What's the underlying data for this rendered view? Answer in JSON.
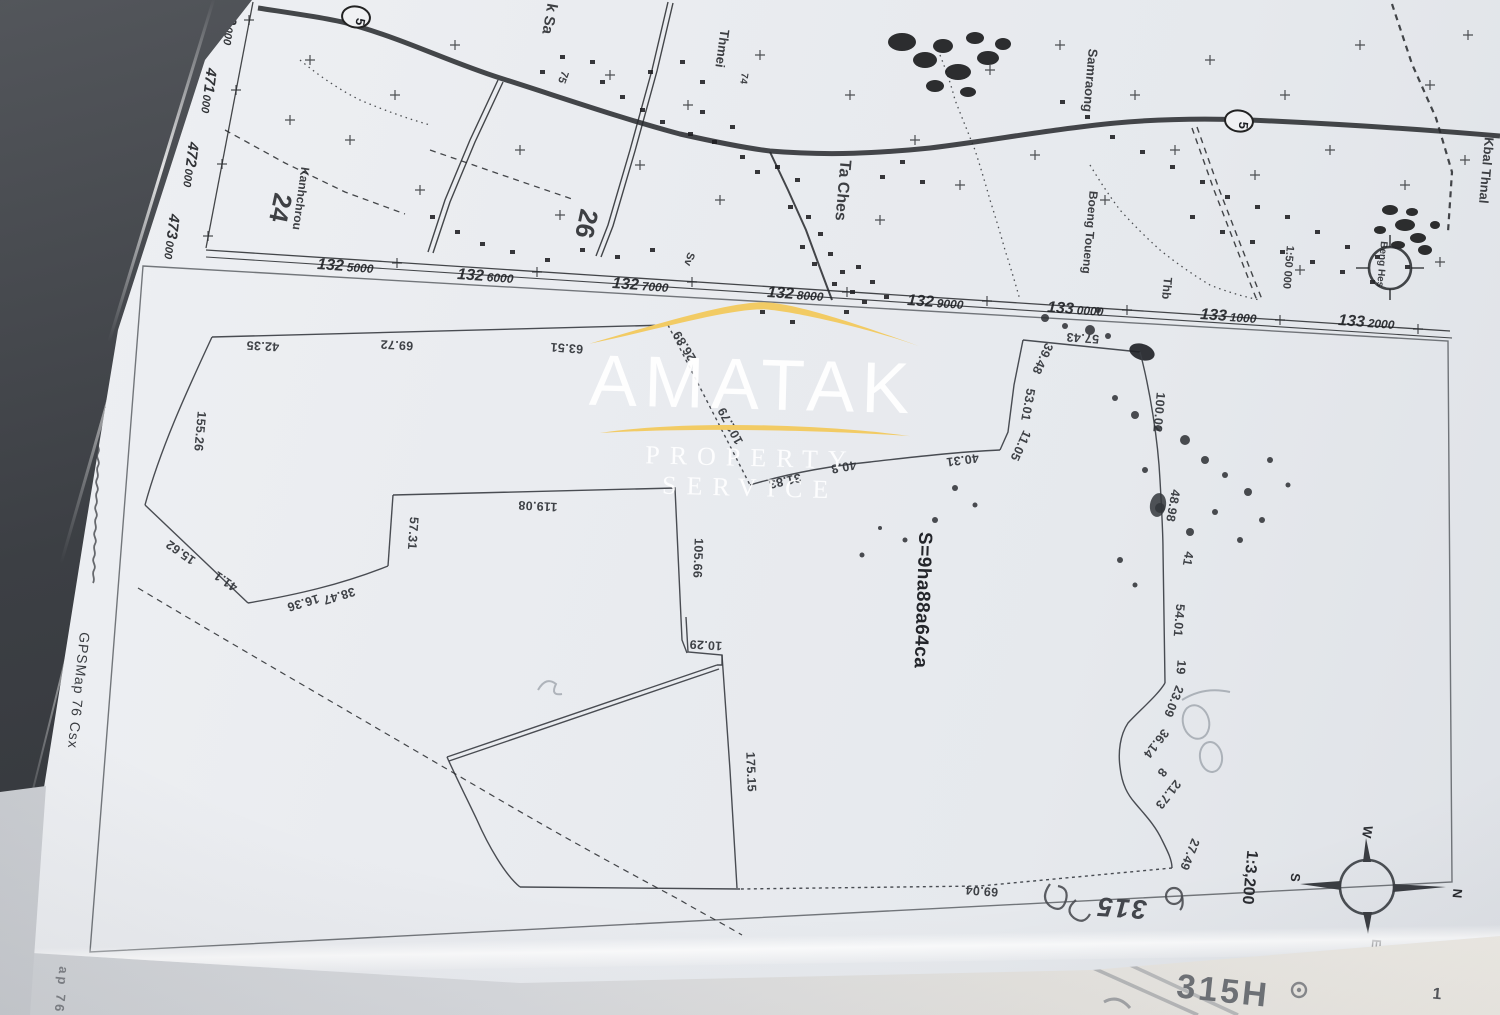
{
  "watermark": {
    "brand": "AMATAK",
    "tagline": "PROPERTY SERVICE",
    "accent_color": "#f2cb64",
    "text_color": "#ffffff"
  },
  "topo_map": {
    "grid_x_labels": [
      {
        "main": "132",
        "sub": "5000",
        "x": 345,
        "y": 271
      },
      {
        "main": "132",
        "sub": "6000",
        "x": 485,
        "y": 281
      },
      {
        "main": "132",
        "sub": "7000",
        "x": 640,
        "y": 290
      },
      {
        "main": "132",
        "sub": "8000",
        "x": 795,
        "y": 299
      },
      {
        "main": "132",
        "sub": "9000",
        "x": 935,
        "y": 307
      },
      {
        "main": "133",
        "sub": "0000",
        "x": 1075,
        "y": 314
      },
      {
        "main": "133",
        "sub": "1000",
        "x": 1228,
        "y": 321
      },
      {
        "main": "133",
        "sub": "2000",
        "x": 1366,
        "y": 327
      }
    ],
    "grid_y_labels": [
      {
        "main": "470",
        "sub": "000",
        "x": 226,
        "y": 22
      },
      {
        "main": "471",
        "sub": "000",
        "x": 204,
        "y": 90
      },
      {
        "main": "472",
        "sub": "000",
        "x": 186,
        "y": 164
      },
      {
        "main": "473",
        "sub": "000",
        "x": 167,
        "y": 236
      }
    ],
    "route_shields": [
      {
        "t": "5",
        "x": 356,
        "y": 17,
        "rot": 100
      },
      {
        "t": "5",
        "x": 1239,
        "y": 121,
        "rot": 95
      }
    ],
    "place_labels": [
      {
        "t": "k Sa",
        "x": 545,
        "y": 18,
        "rot": 100,
        "s": 15
      },
      {
        "t": "75",
        "x": 560,
        "y": 76,
        "rot": 110,
        "s": 11
      },
      {
        "t": "Thmei",
        "x": 718,
        "y": 48,
        "rot": 98,
        "s": 13
      },
      {
        "t": "74",
        "x": 741,
        "y": 78,
        "rot": 98,
        "s": 10
      },
      {
        "t": "Ta Ches",
        "x": 838,
        "y": 190,
        "rot": 95,
        "s": 16
      },
      {
        "t": "Sv",
        "x": 686,
        "y": 258,
        "rot": 108,
        "s": 11
      },
      {
        "t": "26",
        "x": 578,
        "y": 222,
        "rot": 102,
        "s": 26
      },
      {
        "t": "24",
        "x": 272,
        "y": 206,
        "rot": 102,
        "s": 26
      },
      {
        "t": "Kanhchrou",
        "x": 297,
        "y": 198,
        "rot": 98,
        "s": 12
      },
      {
        "t": "Samraong",
        "x": 1086,
        "y": 80,
        "rot": 95,
        "s": 13
      },
      {
        "t": "Boeng Toueng",
        "x": 1086,
        "y": 232,
        "rot": 95,
        "s": 12
      },
      {
        "t": "Thb",
        "x": 1163,
        "y": 288,
        "rot": 95,
        "s": 12
      },
      {
        "t": "Kbal Thnal",
        "x": 1482,
        "y": 170,
        "rot": 95,
        "s": 13
      },
      {
        "t": "1:50 000",
        "x": 1285,
        "y": 267,
        "rot": 95,
        "s": 11
      },
      {
        "t": "Beng Hes",
        "x": 1379,
        "y": 264,
        "rot": 95,
        "s": 10
      }
    ]
  },
  "parcel": {
    "area_label": {
      "v": "S=9ha88a64ca",
      "x": 917,
      "y": 600,
      "rot": 92,
      "s": 19
    },
    "scale_label": {
      "v": "1:3,200",
      "x": 1245,
      "y": 877,
      "rot": 95,
      "s": 16
    },
    "gps_note": {
      "v": "GPSMap 76 Csx",
      "x": 74,
      "y": 690,
      "rot": 96,
      "s": 14
    },
    "handwritten": {
      "v": "315",
      "x": 1122,
      "y": 899,
      "rot": 184,
      "s": 27
    },
    "compass_letters": [
      {
        "t": "W",
        "x": 1363,
        "y": 831,
        "rot": 100
      },
      {
        "t": "S",
        "x": 1291,
        "y": 877,
        "rot": 95
      },
      {
        "t": "E",
        "x": 1372,
        "y": 943,
        "rot": 95
      },
      {
        "t": "N",
        "x": 1453,
        "y": 893,
        "rot": 95
      }
    ],
    "measurements": [
      {
        "v": "42.35",
        "x": 263,
        "y": 342,
        "rot": 183
      },
      {
        "v": "69.72",
        "x": 397,
        "y": 341,
        "rot": 183
      },
      {
        "v": "63.51",
        "x": 567,
        "y": 344,
        "rot": 184
      },
      {
        "v": "26.89",
        "x": 688,
        "y": 344,
        "rot": 239
      },
      {
        "v": "102.79",
        "x": 734,
        "y": 424,
        "rot": 242
      },
      {
        "v": "57.43",
        "x": 1083,
        "y": 334,
        "rot": 184
      },
      {
        "v": "155.26",
        "x": 196,
        "y": 431,
        "rot": 95
      },
      {
        "v": "15.62",
        "x": 183,
        "y": 549,
        "rot": 215
      },
      {
        "v": "41.1",
        "x": 228,
        "y": 578,
        "rot": 215
      },
      {
        "v": "38.47",
        "x": 338,
        "y": 592,
        "rot": 163
      },
      {
        "v": "16.36",
        "x": 302,
        "y": 599,
        "rot": 163
      },
      {
        "v": "57.31",
        "x": 409,
        "y": 533,
        "rot": 94
      },
      {
        "v": "119.08",
        "x": 538,
        "y": 502,
        "rot": 183
      },
      {
        "v": "105.66",
        "x": 694,
        "y": 558,
        "rot": 92
      },
      {
        "v": "10.29",
        "x": 706,
        "y": 641,
        "rot": 183
      },
      {
        "v": "175.15",
        "x": 747,
        "y": 772,
        "rot": 88
      },
      {
        "v": "31.83",
        "x": 784,
        "y": 477,
        "rot": 167
      },
      {
        "v": "40.8",
        "x": 843,
        "y": 463,
        "rot": 170
      },
      {
        "v": "40.31",
        "x": 962,
        "y": 456,
        "rot": 172
      },
      {
        "v": "11.05",
        "x": 1017,
        "y": 444,
        "rot": 115
      },
      {
        "v": "53.01",
        "x": 1024,
        "y": 404,
        "rot": 100
      },
      {
        "v": "39.48",
        "x": 1039,
        "y": 357,
        "rot": 115
      },
      {
        "v": "100.02",
        "x": 1155,
        "y": 412,
        "rot": 95
      },
      {
        "v": "48.98",
        "x": 1169,
        "y": 505,
        "rot": 100
      },
      {
        "v": "41",
        "x": 1184,
        "y": 558,
        "rot": 100
      },
      {
        "v": "54.01",
        "x": 1175,
        "y": 620,
        "rot": 95
      },
      {
        "v": "19",
        "x": 1177,
        "y": 667,
        "rot": 95
      },
      {
        "v": "23.09",
        "x": 1170,
        "y": 700,
        "rot": 112
      },
      {
        "v": "36.14",
        "x": 1153,
        "y": 741,
        "rot": 128
      },
      {
        "v": "8",
        "x": 1159,
        "y": 770,
        "rot": 128
      },
      {
        "v": "21.73",
        "x": 1165,
        "y": 792,
        "rot": 128
      },
      {
        "v": "27.49",
        "x": 1186,
        "y": 853,
        "rot": 112
      },
      {
        "v": "69.04",
        "x": 982,
        "y": 887,
        "rot": 184
      }
    ]
  },
  "under_sheet": {
    "items": [
      {
        "t": "315H",
        "x": 1222,
        "y": 1002,
        "rot": 6,
        "s": 34,
        "c": "#6f7277"
      },
      {
        "t": "1",
        "x": 1438,
        "y": 999,
        "rot": 5,
        "s": 16,
        "c": "#55575b"
      },
      {
        "t": "ap 76",
        "x": 57,
        "y": 990,
        "rot": 96,
        "s": 13,
        "c": "#7e8186"
      }
    ]
  }
}
